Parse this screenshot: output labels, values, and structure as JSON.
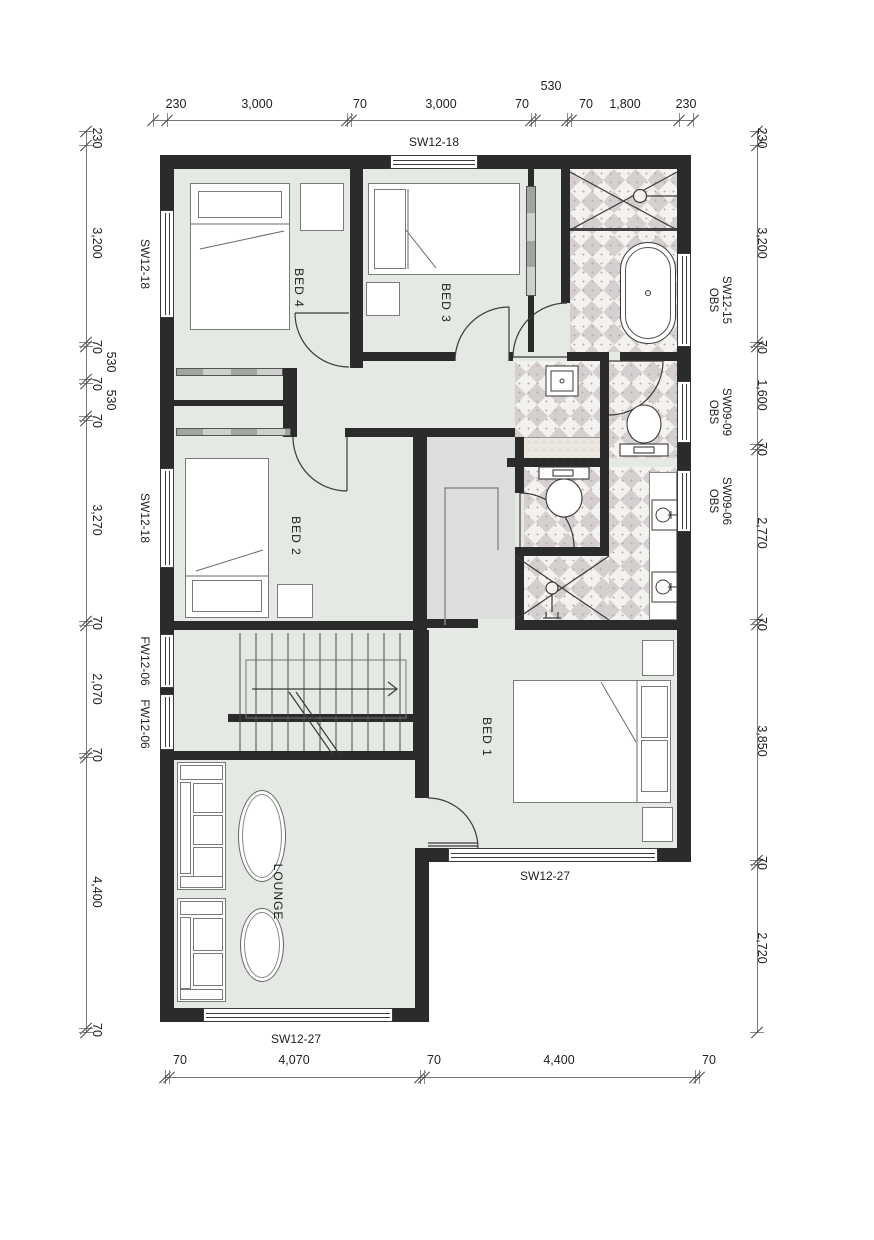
{
  "rooms": {
    "bed4": "BED 4",
    "bed3": "BED 3",
    "bed2": "BED 2",
    "bed1": "BED 1",
    "lounge": "LOUNGE"
  },
  "windows": {
    "top": "SW12-18",
    "left": [
      "SW12-18",
      "SW12-18",
      "FW12-06",
      "FW12-06"
    ],
    "right": [
      {
        "code": "SW12-15",
        "obs": "OBS"
      },
      {
        "code": "SW09-09",
        "obs": "OBS"
      },
      {
        "code": "SW09-06",
        "obs": "OBS"
      }
    ],
    "bottom": [
      "SW12-27",
      "SW12-27"
    ]
  },
  "dimensions": {
    "top": [
      "230",
      "3,000",
      "70",
      "3,000",
      "70",
      "530",
      "70",
      "1,800",
      "230"
    ],
    "left": [
      "230",
      "3,200",
      "70",
      "530",
      "70",
      "530",
      "70",
      "3,270",
      "70",
      "2,070",
      "70",
      "4,400",
      "70"
    ],
    "right": [
      "230",
      "3,200",
      "70",
      "1,600",
      "70",
      "2,770",
      "70",
      "3,850",
      "70",
      "2,720"
    ],
    "bottom": [
      "70",
      "4,070",
      "70",
      "4,400",
      "70"
    ]
  },
  "colors": {
    "wall": "#2b2b2b",
    "floor": "#e4e9e4",
    "tile_dark": "#d6cfcf",
    "tile_light": "#f4f2ef",
    "wardrobe": "#dcdedb",
    "counter": "#ece7df"
  }
}
